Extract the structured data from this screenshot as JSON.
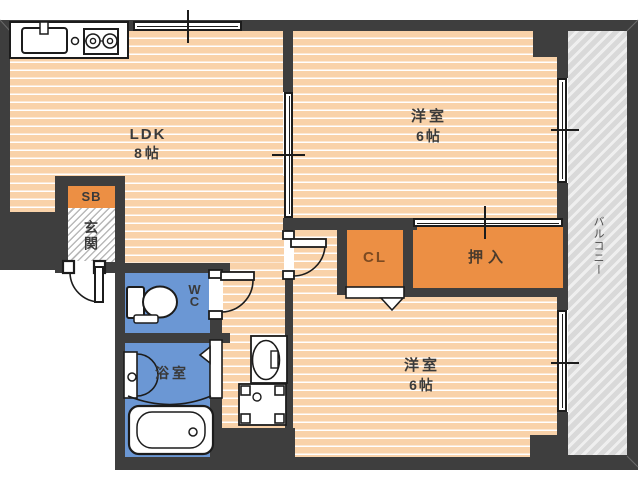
{
  "plan_type": "apartment-floorplan",
  "rooms": {
    "ldk_name": "LDK",
    "ldk_size": "8帖",
    "bedroom1_name": "洋室",
    "bedroom1_size": "6帖",
    "bedroom2_name": "洋室",
    "bedroom2_size": "6帖",
    "closet_label": "CL",
    "oshiire_label": "押入",
    "wc_label": "WC",
    "bath_label": "浴室",
    "entrance_label": "玄関",
    "shoebox_label": "SB",
    "balcony_label": "バルコニー"
  },
  "colors": {
    "wall": "#3e3e3e",
    "floor_peach": "#f9d2a9",
    "closet_orange": "#ec8f44",
    "wet_area_blue": "#6b97d4",
    "balcony_gray": "#d9d9d9",
    "closet_text_brown": "#7c4a21"
  }
}
